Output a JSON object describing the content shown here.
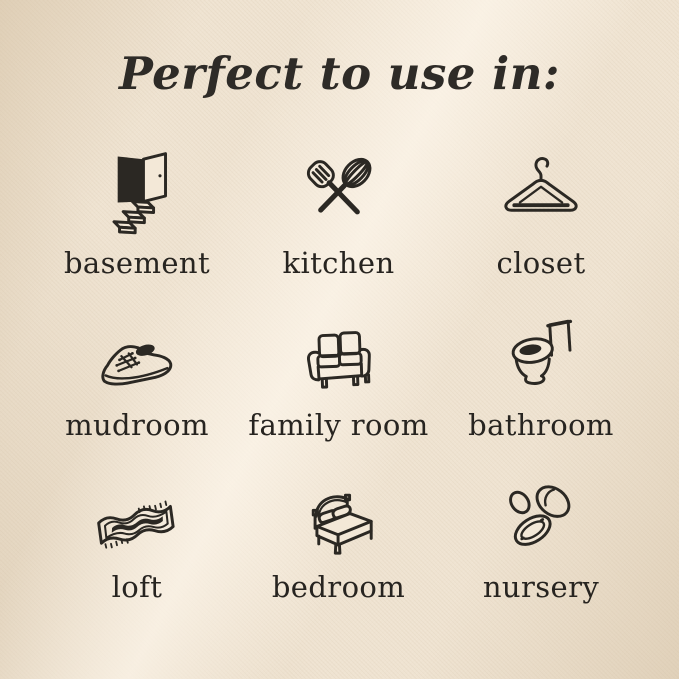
{
  "title": "Perfect to use in:",
  "colors": {
    "background": "#efe3d1",
    "background_highlight": "#f8efe1",
    "background_shadow": "#e3d3bb",
    "ink": "#2b2823"
  },
  "rooms": [
    {
      "label": "basement",
      "icon": "basement-stairs-icon"
    },
    {
      "label": "kitchen",
      "icon": "kitchen-utensils-icon"
    },
    {
      "label": "closet",
      "icon": "clothes-hanger-icon"
    },
    {
      "label": "mudroom",
      "icon": "sneaker-icon"
    },
    {
      "label": "family room",
      "icon": "sofa-icon"
    },
    {
      "label": "bathroom",
      "icon": "toilet-icon"
    },
    {
      "label": "loft",
      "icon": "rug-icon"
    },
    {
      "label": "bedroom",
      "icon": "bed-icon"
    },
    {
      "label": "nursery",
      "icon": "pacifier-icon"
    }
  ]
}
